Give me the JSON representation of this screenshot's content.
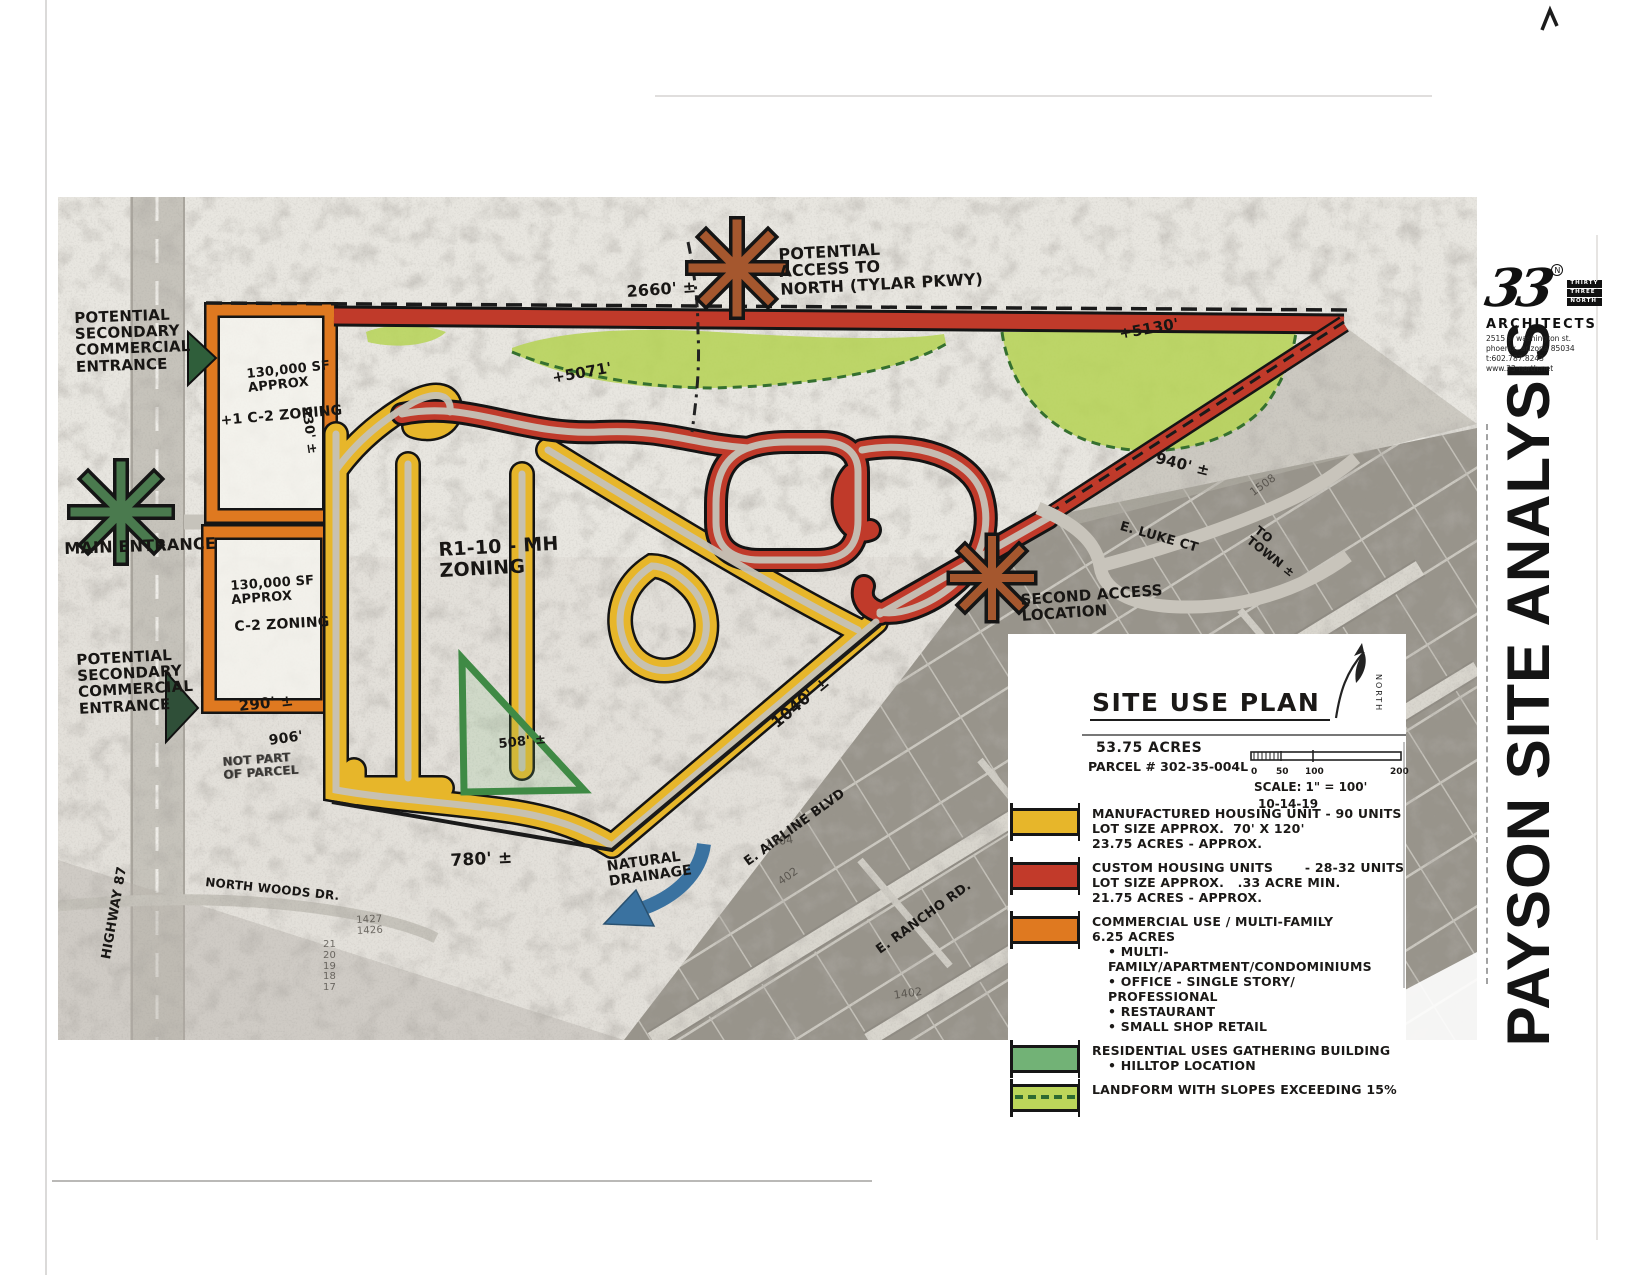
{
  "page": {
    "title": "PAYSON SITE ANALYSIS"
  },
  "logo": {
    "number": "33",
    "reg": "N",
    "stack": [
      "THIRTY",
      "THREE",
      "NORTH"
    ],
    "firm": "ARCHITECTS",
    "address1": "2515 s. washington st.",
    "address2": "phoenix, arizona 85034",
    "address3": "t:602.787.8243",
    "address4": "www.33-north.net"
  },
  "legend": {
    "heading": "SITE USE PLAN",
    "acres": "53.75 ACRES",
    "parcel": "PARCEL # 302-35-004L",
    "scale_ticks": [
      "0",
      "50",
      "100",
      "200"
    ],
    "scale_label": "SCALE: 1\" = 100'",
    "date": "10-14-19",
    "north_label": "NORTH",
    "items": [
      {
        "color": "#e7b62a",
        "swatch": "solid",
        "lines": [
          "MANUFACTURED HOUSING UNIT - 90 UNITS",
          "LOT SIZE APPROX.  70' X 120'",
          "23.75 ACRES - APPROX."
        ]
      },
      {
        "color": "#c23a2a",
        "swatch": "solid",
        "lines": [
          "CUSTOM HOUSING UNITS       - 28-32 UNITS",
          "LOT SIZE APPROX.   .33 ACRE MIN.",
          "21.75 ACRES - APPROX."
        ]
      },
      {
        "color": "#df7920",
        "swatch": "solid",
        "lines": [
          "COMMERCIAL USE / MULTI-FAMILY",
          "6.25 ACRES"
        ],
        "bullets": [
          "MULTI-FAMILY/APARTMENT/CONDOMINIUMS",
          "OFFICE - SINGLE STORY/ PROFESSIONAL",
          "RESTAURANT",
          "SMALL SHOP RETAIL"
        ]
      },
      {
        "color": "#72b276",
        "swatch": "solid",
        "lines": [
          "RESIDENTIAL USES GATHERING BUILDING"
        ],
        "bullets": [
          "HILLTOP LOCATION"
        ]
      },
      {
        "color": "#bcd65a",
        "swatch": "dashed",
        "lines": [
          "LANDFORM WITH SLOPES EXCEEDING 15%"
        ]
      }
    ]
  },
  "map": {
    "labels": [
      {
        "name": "potential-access-north-label",
        "text": "POTENTIAL\nACCESS TO\nNORTH (TYLAR PKWY)",
        "x": 778,
        "y": 246,
        "rot": -3,
        "size": 16
      },
      {
        "name": "dim-2660",
        "text": "2660' ±",
        "x": 626,
        "y": 283,
        "rot": -4,
        "size": 16
      },
      {
        "name": "elev-5071",
        "text": "+5071'",
        "x": 551,
        "y": 370,
        "rot": -10,
        "size": 15
      },
      {
        "name": "elev-5130",
        "text": "+5130'",
        "x": 1118,
        "y": 326,
        "rot": -10,
        "size": 15
      },
      {
        "name": "dim-940",
        "text": "940' ±",
        "x": 1158,
        "y": 450,
        "rot": 14,
        "size": 15
      },
      {
        "name": "street-e-luke-ct",
        "text": "E. LUKE CT",
        "x": 1122,
        "y": 520,
        "rot": 16,
        "size": 13
      },
      {
        "name": "to-town-note",
        "text": "TO\nTOWN ±",
        "x": 1260,
        "y": 524,
        "rot": 38,
        "size": 12
      },
      {
        "name": "potential-secondary-entrance-1-label",
        "text": "POTENTIAL\nSECONDARY\nCOMMERCIAL\nENTRANCE",
        "x": 74,
        "y": 310,
        "rot": -2,
        "size": 15
      },
      {
        "name": "main-entrance-label",
        "text": "MAIN ENTRANCE",
        "x": 64,
        "y": 540,
        "rot": -2,
        "size": 16
      },
      {
        "name": "commercial-parcel-1-sf",
        "text": "130,000 SF\nAPPROX",
        "x": 246,
        "y": 368,
        "rot": -6,
        "size": 13
      },
      {
        "name": "commercial-parcel-1-zoning",
        "text": "+1  C-2 ZONING",
        "x": 220,
        "y": 414,
        "rot": -5,
        "size": 14
      },
      {
        "name": "dim-930",
        "text": "930' ±",
        "x": 312,
        "y": 406,
        "rot": 82,
        "size": 13
      },
      {
        "name": "potential-secondary-entrance-2-label",
        "text": "POTENTIAL\nSECONDARY\nCOMMERCIAL\nENTRANCE",
        "x": 76,
        "y": 652,
        "rot": -3,
        "size": 15
      },
      {
        "name": "commercial-parcel-2-sf",
        "text": "130,000 SF\nAPPROX",
        "x": 230,
        "y": 580,
        "rot": -4,
        "size": 13
      },
      {
        "name": "commercial-parcel-2-zoning",
        "text": "C-2 ZONING",
        "x": 234,
        "y": 620,
        "rot": -3,
        "size": 14
      },
      {
        "name": "dim-290",
        "text": "290' ±",
        "x": 238,
        "y": 698,
        "rot": -6,
        "size": 15
      },
      {
        "name": "dim-906",
        "text": "906'",
        "x": 268,
        "y": 734,
        "rot": -8,
        "size": 14
      },
      {
        "name": "not-part-of-parcel-note",
        "text": "NOT PART\nOF PARCEL",
        "x": 222,
        "y": 756,
        "rot": -4,
        "size": 12,
        "cls": "scratch"
      },
      {
        "name": "zoning-r1-10-mh-label",
        "text": "R1-10 - MH\nZONING",
        "x": 438,
        "y": 540,
        "rot": -3,
        "size": 19
      },
      {
        "name": "second-access-location-label",
        "text": "SECOND ACCESS\nLOCATION",
        "x": 1020,
        "y": 592,
        "rot": -4,
        "size": 15
      },
      {
        "name": "dim-508",
        "text": "508' ±",
        "x": 498,
        "y": 738,
        "rot": -6,
        "size": 13
      },
      {
        "name": "dim-1040",
        "text": "1040' ±",
        "x": 768,
        "y": 718,
        "rot": -40,
        "size": 16
      },
      {
        "name": "dim-780",
        "text": "780' ±",
        "x": 450,
        "y": 852,
        "rot": -3,
        "size": 17
      },
      {
        "name": "natural-drainage-label",
        "text": "NATURAL\nDRAINAGE",
        "x": 606,
        "y": 860,
        "rot": -8,
        "size": 14
      },
      {
        "name": "street-e-airline-blvd",
        "text": "E. AIRLINE BLVD",
        "x": 742,
        "y": 858,
        "rot": -36,
        "size": 13
      },
      {
        "name": "street-e-rancho-rd",
        "text": "E. RANCHO RD.",
        "x": 874,
        "y": 946,
        "rot": -36,
        "size": 13
      },
      {
        "name": "street-north-woods-dr",
        "text": "NORTH WOODS DR.",
        "x": 206,
        "y": 876,
        "rot": 6,
        "size": 12
      },
      {
        "name": "street-highway-87",
        "text": "HIGHWAY 87",
        "x": 100,
        "y": 958,
        "rot": -80,
        "size": 13
      },
      {
        "name": "parcel-num-1508",
        "text": "1508",
        "x": 1248,
        "y": 489,
        "rot": -36,
        "size": 11,
        "cls": "faint"
      },
      {
        "name": "parcel-num-1504",
        "text": "1504",
        "x": 764,
        "y": 838,
        "rot": -8,
        "size": 11,
        "cls": "faint"
      },
      {
        "name": "parcel-num-402",
        "text": "402",
        "x": 776,
        "y": 878,
        "rot": -36,
        "size": 11,
        "cls": "faint"
      },
      {
        "name": "parcel-num-1402",
        "text": "1402",
        "x": 893,
        "y": 990,
        "rot": -8,
        "size": 11,
        "cls": "faint"
      },
      {
        "name": "parcel-num-1427-1426",
        "text": "1427\n1426",
        "x": 356,
        "y": 916,
        "rot": -3,
        "size": 10,
        "cls": "faint"
      },
      {
        "name": "lot-number-column",
        "text": "21\n20\n19\n18\n17",
        "x": 323,
        "y": 940,
        "rot": 0,
        "size": 10,
        "cls": "faint"
      }
    ]
  }
}
